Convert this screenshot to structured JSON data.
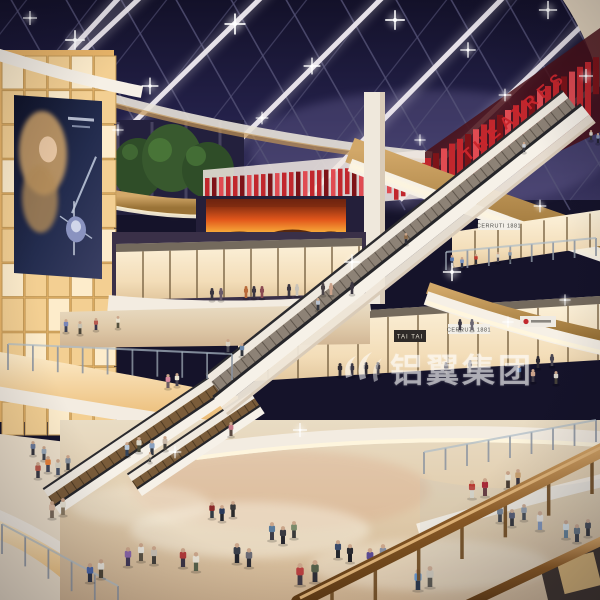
{
  "scene": {
    "signs": {
      "theatres": "THEATRES",
      "tai_tai": "TAI TAI",
      "cerruti_upper": "CERRUTI 1881",
      "cerruti_mid": "CERRUTI 1881",
      "watermark": "铝翼集团"
    },
    "palette": {
      "sky_top": "#131129",
      "sky_mid": "#2b2750",
      "sky_glow": "#6f6899",
      "rib": "#efeaf0",
      "mullion": "#555377",
      "fin_red": "#c1272d",
      "fin_dark": "#7e1318",
      "fin_light": "#e04b52",
      "fin_backing": "#f0e7e1",
      "theatre_text": "#c9252c",
      "wall_panel": "#f3cf92",
      "wall_panel_bright": "#fdeccb",
      "wall_gap": "#c49a58",
      "wood": "#c39556",
      "wood_dark": "#9a7337",
      "wood_rail": "#8a5a26",
      "wood_rail_light": "#d9a868",
      "fascia": "#f3ece1",
      "fascia_shadow": "#d9cbb8",
      "cove": "#fff6dd",
      "floor": "#e4d2b8",
      "floor_warm": "#d9b896",
      "floor_bright": "#f6efdf",
      "store_glow": "#f9ead0",
      "store_frame": "#7a6444",
      "sign_band": "#5c5248",
      "fire_dark": "#5a1a0c",
      "fire_mid": "#e2571b",
      "fire_light": "#f9b13c",
      "tree": "#2f4d28",
      "tree_light": "#4c7a3a",
      "glass": "#aebdc8",
      "ad_bg": "#161c34",
      "ad_hair": "#c49b66",
      "ad_silver": "#c3cde0",
      "watermark": "#ffffff"
    },
    "wall_panels": {
      "x": 2,
      "y": 56,
      "cols": 5,
      "rows": 11,
      "pw": 21.5,
      "ph": 33,
      "gap": 1.6
    },
    "fins": [
      {
        "x0": 205,
        "x1": 423,
        "step": 7,
        "top": 178,
        "slope": -0.07,
        "hmin": 26,
        "hmax": 36,
        "w": 4.5
      },
      {
        "x0": 425,
        "x1": 597,
        "step": 8,
        "top": 158,
        "slope": -0.6,
        "hmin": 34,
        "hmax": 58,
        "w": 6
      }
    ],
    "store_rows": [
      {
        "x0": 116,
        "x1": 362,
        "ytop0": 244,
        "ytop1": 238,
        "h": 56,
        "gap": 27,
        "dark_top": true
      },
      {
        "x0": 452,
        "x1": 600,
        "ytop0": 232,
        "ytop1": 210,
        "h": 36,
        "gap": 23,
        "dark_top": false
      },
      {
        "x0": 238,
        "x1": 600,
        "ytop0": 318,
        "ytop1": 296,
        "h": 64,
        "gap": 30,
        "dark_top": true
      },
      {
        "x0": 205,
        "x1": 600,
        "ytop0": 452,
        "ytop1": 432,
        "h": 58,
        "gap": 28,
        "dark_top": false
      }
    ],
    "post_rows": [
      {
        "x0": 8,
        "x1": 232,
        "y0": 344,
        "y1": 354,
        "h": 26,
        "n": 10
      },
      {
        "x0": 2,
        "x1": 118,
        "y0": 524,
        "y1": 586,
        "h": 30,
        "n": 6
      },
      {
        "x0": 446,
        "x1": 596,
        "y0": 252,
        "y1": 238,
        "h": 18,
        "n": 8
      },
      {
        "x0": 424,
        "x1": 596,
        "y0": 452,
        "y1": 420,
        "h": 22,
        "n": 9
      }
    ],
    "rail_posts": {
      "x0": 332,
      "x1": 592,
      "y0": 584,
      "y1": 454,
      "h": 40,
      "n": 7
    },
    "lights": [
      [
        30,
        18,
        1.0
      ],
      [
        75,
        40,
        1.4
      ],
      [
        150,
        86,
        1.2
      ],
      [
        235,
        24,
        1.5
      ],
      [
        312,
        66,
        1.2
      ],
      [
        395,
        20,
        1.4
      ],
      [
        468,
        50,
        1.1
      ],
      [
        548,
        10,
        1.3
      ],
      [
        586,
        76,
        1.0
      ],
      [
        262,
        118,
        0.9
      ],
      [
        118,
        130,
        0.8
      ],
      [
        505,
        95,
        0.9
      ],
      [
        352,
        262,
        1.1
      ],
      [
        452,
        272,
        1.3
      ],
      [
        540,
        206,
        0.9
      ],
      [
        300,
        430,
        1.0
      ],
      [
        175,
        452,
        0.9
      ],
      [
        508,
        322,
        0.8
      ],
      [
        420,
        140,
        0.8
      ],
      [
        565,
        300,
        0.8
      ]
    ],
    "people": [
      [
        66,
        332,
        13,
        "#7a86b8",
        "#3a3f55"
      ],
      [
        80,
        334,
        13,
        "#c8c2b2",
        "#4a4438"
      ],
      [
        96,
        330,
        12,
        "#b85a50",
        "#39344a"
      ],
      [
        118,
        328,
        12,
        "#e8e0cc",
        "#55513f"
      ],
      [
        168,
        388,
        14,
        "#d88aa0",
        "#6a5a62"
      ],
      [
        177,
        386,
        13,
        "#e8e2d0",
        "#46424e"
      ],
      [
        228,
        352,
        13,
        "#d8d0c0",
        "#4a4a55"
      ],
      [
        242,
        356,
        13,
        "#6a86a8",
        "#30343c"
      ],
      [
        33,
        455,
        14,
        "#6a7a9a",
        "#34343c"
      ],
      [
        44,
        460,
        14,
        "#98a8b8",
        "#40444c"
      ],
      [
        38,
        478,
        16,
        "#b85a4a",
        "#3a3a44"
      ],
      [
        48,
        472,
        16,
        "#e8813a",
        "#44485a"
      ],
      [
        58,
        475,
        16,
        "#d8d2c2",
        "#4a5468"
      ],
      [
        68,
        470,
        15,
        "#88929e",
        "#33363c"
      ],
      [
        52,
        518,
        17,
        "#d8b8a0",
        "#7a6a5a"
      ],
      [
        63,
        515,
        17,
        "#e8e2d2",
        "#8a7a62"
      ],
      [
        90,
        582,
        19,
        "#4a66a8",
        "#2e3446"
      ],
      [
        101,
        578,
        19,
        "#e8e4da",
        "#4e4637"
      ],
      [
        127,
        456,
        14,
        "#b8c8d8",
        "#33445a"
      ],
      [
        139,
        452,
        15,
        "#d8d4c6",
        "#4a4a3a"
      ],
      [
        152,
        455,
        15,
        "#88a0c0",
        "#333842"
      ],
      [
        150,
        462,
        10,
        "#e8d8c0",
        "#555550"
      ],
      [
        165,
        450,
        14,
        "#c8b8a8",
        "#44403a"
      ],
      [
        231,
        436,
        14,
        "#c87a88",
        "#5a4a42"
      ],
      [
        128,
        566,
        19,
        "#8a66a8",
        "#423a58"
      ],
      [
        141,
        561,
        18,
        "#e8e4da",
        "#5a5244"
      ],
      [
        154,
        564,
        18,
        "#c8c0b4",
        "#43403a"
      ],
      [
        183,
        567,
        19,
        "#b03a3a",
        "#3a3444"
      ],
      [
        196,
        571,
        19,
        "#e8e2d4",
        "#55604a"
      ],
      [
        237,
        563,
        20,
        "#3a3f4a",
        "#23242c"
      ],
      [
        249,
        567,
        19,
        "#6a6a74",
        "#2a2a32"
      ],
      [
        272,
        540,
        18,
        "#5a7a9a",
        "#3c3c46"
      ],
      [
        283,
        544,
        18,
        "#3a3a42",
        "#26262e"
      ],
      [
        294,
        538,
        17,
        "#7a8a6a",
        "#3a3a3a"
      ],
      [
        212,
        518,
        16,
        "#8a2a2a",
        "#333a44"
      ],
      [
        222,
        521,
        16,
        "#2a3a5a",
        "#23262e"
      ],
      [
        233,
        517,
        16,
        "#3a3a3a",
        "#2a2a2a"
      ],
      [
        300,
        585,
        22,
        "#b84040",
        "#3f3a46"
      ],
      [
        315,
        582,
        22,
        "#55604a",
        "#2e2e36"
      ],
      [
        338,
        558,
        18,
        "#3a4a6a",
        "#23262c"
      ],
      [
        350,
        562,
        18,
        "#2a2a30",
        "#1e1e24"
      ],
      [
        370,
        568,
        20,
        "#5a4a92",
        "#303038"
      ],
      [
        383,
        563,
        19,
        "#8890a2",
        "#3a3e48"
      ],
      [
        418,
        590,
        21,
        "#6a9ad0",
        "#2e3a4e"
      ],
      [
        430,
        587,
        21,
        "#d0c8b8",
        "#4e4a42"
      ],
      [
        472,
        498,
        18,
        "#b83a32",
        "#d8d4c8"
      ],
      [
        485,
        496,
        18,
        "#a82a38",
        "#5a2a30"
      ],
      [
        508,
        488,
        17,
        "#e8e2d2",
        "#4a3e34"
      ],
      [
        518,
        485,
        16,
        "#c8a070",
        "#3a3640"
      ],
      [
        500,
        522,
        17,
        "#6a7a8e",
        "#33363e"
      ],
      [
        512,
        526,
        17,
        "#49506a",
        "#23242a"
      ],
      [
        524,
        520,
        16,
        "#8a96a6",
        "#3a3e46"
      ],
      [
        540,
        530,
        19,
        "#e8e4dc",
        "#7a90b8"
      ],
      [
        566,
        538,
        18,
        "#d8e2e6",
        "#5a7a92"
      ],
      [
        577,
        542,
        18,
        "#5a6a7a",
        "#2e333c"
      ],
      [
        588,
        536,
        17,
        "#3a3e4a",
        "#26262c"
      ],
      [
        452,
        266,
        11,
        "#5a7ab0",
        "#36405a"
      ],
      [
        462,
        268,
        11,
        "#7a94c0",
        "#2e3448"
      ],
      [
        476,
        264,
        10,
        "#c0392f",
        "#33333b"
      ],
      [
        498,
        262,
        10,
        "#d8d2c4",
        "#55505a"
      ],
      [
        510,
        260,
        10,
        "#8898aa",
        "#44444c"
      ],
      [
        591,
        140,
        10,
        "#d8d4c8",
        "#333333"
      ],
      [
        598,
        143,
        10,
        "#8a9ab8",
        "#222233"
      ],
      [
        524,
        152,
        10,
        "#c8ccd4",
        "#3a3a42"
      ],
      [
        406,
        244,
        11,
        "#8a6a4a",
        "#2e2e36"
      ],
      [
        318,
        310,
        12,
        "#b8c0cc",
        "#33363e"
      ],
      [
        519,
        378,
        13,
        "#4a6a9a",
        "#2c2c34"
      ],
      [
        533,
        382,
        13,
        "#caa28a",
        "#3c3844"
      ],
      [
        556,
        384,
        13,
        "#d8d4ca",
        "#46423a"
      ]
    ],
    "mannequins": [
      [
        212,
        300,
        12,
        "#3a3540"
      ],
      [
        221,
        300,
        12,
        "#6a5a6a"
      ],
      [
        246,
        298,
        12,
        "#b86a3a"
      ],
      [
        254,
        298,
        12,
        "#3a3540"
      ],
      [
        262,
        298,
        12,
        "#8a4a52"
      ],
      [
        289,
        296,
        12,
        "#3a3540"
      ],
      [
        297,
        296,
        12,
        "#c8c2b8"
      ],
      [
        323,
        295,
        12,
        "#4a4448"
      ],
      [
        331,
        295,
        12,
        "#caa28a"
      ],
      [
        352,
        294,
        12,
        "#3a3540"
      ],
      [
        340,
        376,
        13,
        "#2e2a32"
      ],
      [
        352,
        376,
        13,
        "#3a3642"
      ],
      [
        366,
        375,
        13,
        "#2e2a32"
      ],
      [
        378,
        375,
        13,
        "#44404a"
      ],
      [
        446,
        374,
        12,
        "#3a3642"
      ],
      [
        470,
        372,
        12,
        "#56525c"
      ],
      [
        460,
        330,
        11,
        "#3a3642"
      ],
      [
        472,
        330,
        11,
        "#6a6672"
      ],
      [
        538,
        368,
        12,
        "#2e2a32"
      ],
      [
        552,
        366,
        12,
        "#4a4652"
      ]
    ]
  }
}
